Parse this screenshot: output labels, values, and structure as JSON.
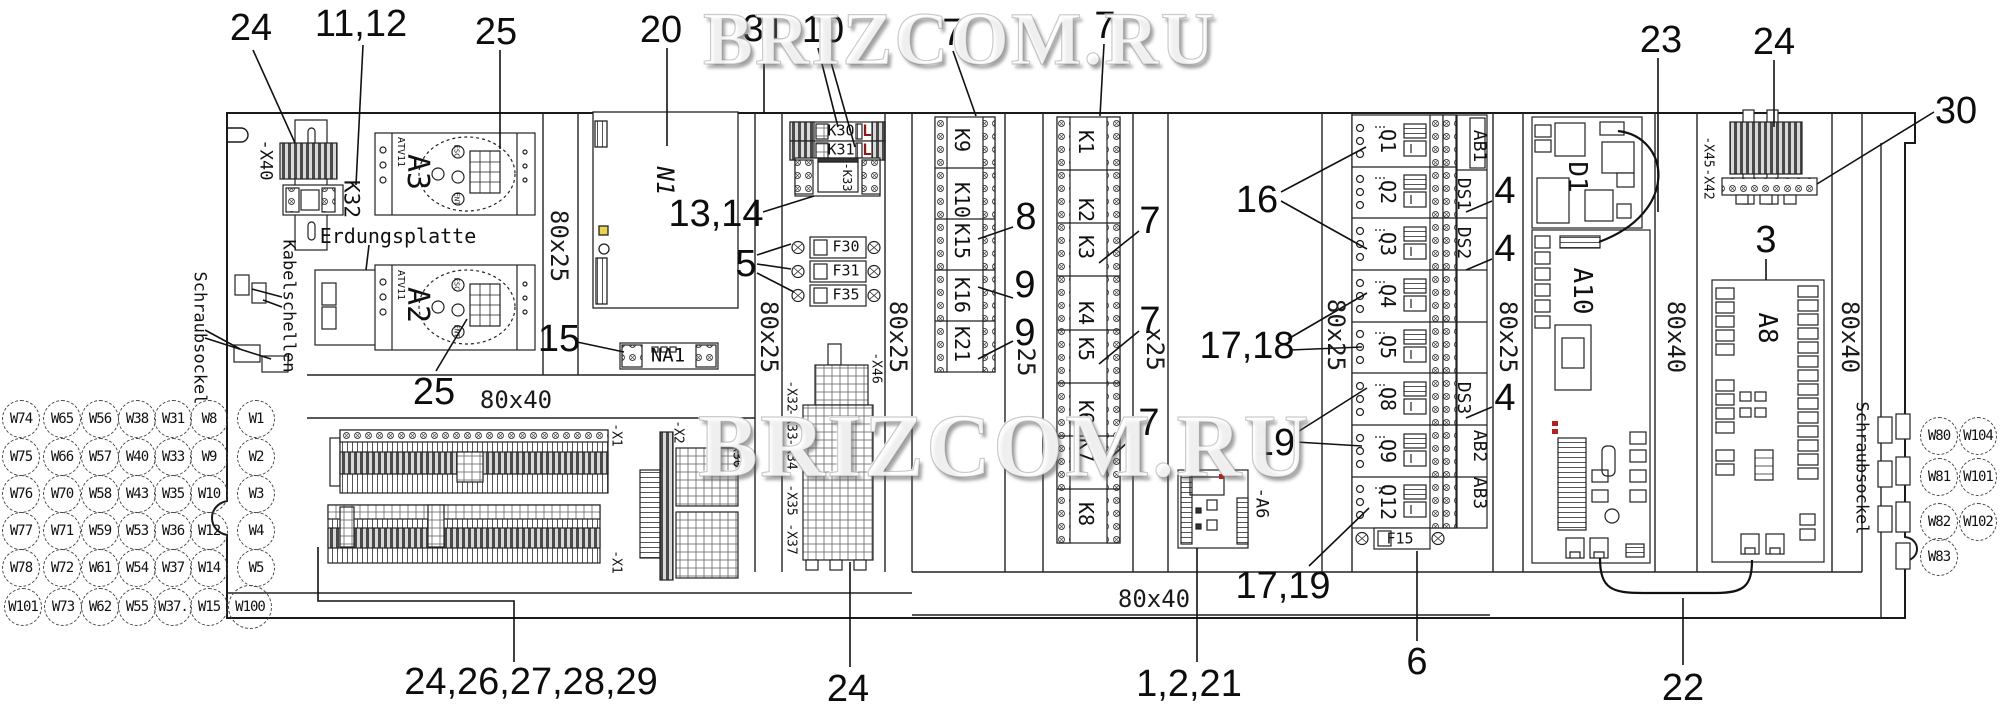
{
  "watermark": {
    "text": "BRIZCOM.RU"
  },
  "colors": {
    "line": "#1a1a1a",
    "background": "#ffffff",
    "led_red": "#b22222",
    "marker_yellow": "#e8d44d",
    "relay_l_red": "#8b1a1a"
  },
  "callouts": [
    {
      "t": "24",
      "x": 251,
      "y": 28
    },
    {
      "t": "11,12",
      "x": 361,
      "y": 24
    },
    {
      "t": "25",
      "x": 496,
      "y": 32
    },
    {
      "t": "20",
      "x": 661,
      "y": 30
    },
    {
      "t": "31",
      "x": 764,
      "y": 29
    },
    {
      "t": "10",
      "x": 823,
      "y": 30
    },
    {
      "t": "7",
      "x": 953,
      "y": 33
    },
    {
      "t": "7",
      "x": 1105,
      "y": 26
    },
    {
      "t": "23",
      "x": 1661,
      "y": 40
    },
    {
      "t": "24",
      "x": 1774,
      "y": 42
    },
    {
      "t": "30",
      "x": 1956,
      "y": 111
    },
    {
      "t": "13,14",
      "x": 716,
      "y": 214
    },
    {
      "t": "5",
      "x": 746,
      "y": 264
    },
    {
      "t": "15",
      "x": 559,
      "y": 339
    },
    {
      "t": "8",
      "x": 1026,
      "y": 217
    },
    {
      "t": "9",
      "x": 1025,
      "y": 285
    },
    {
      "t": "9",
      "x": 1025,
      "y": 333
    },
    {
      "t": "7",
      "x": 1150,
      "y": 221
    },
    {
      "t": "7",
      "x": 1150,
      "y": 321
    },
    {
      "t": "7",
      "x": 1149,
      "y": 423
    },
    {
      "t": "16",
      "x": 1257,
      "y": 200
    },
    {
      "t": "17,18",
      "x": 1247,
      "y": 346
    },
    {
      "t": "19",
      "x": 1274,
      "y": 443
    },
    {
      "t": "4",
      "x": 1505,
      "y": 191
    },
    {
      "t": "4",
      "x": 1505,
      "y": 249
    },
    {
      "t": "4",
      "x": 1505,
      "y": 398
    },
    {
      "t": "3",
      "x": 1766,
      "y": 240
    },
    {
      "t": "17,19",
      "x": 1283,
      "y": 586
    },
    {
      "t": "6",
      "x": 1417,
      "y": 662
    },
    {
      "t": "1,2,21",
      "x": 1189,
      "y": 684
    },
    {
      "t": "24",
      "x": 848,
      "y": 689
    },
    {
      "t": "24,26,27,28,29",
      "x": 531,
      "y": 682
    },
    {
      "t": "22",
      "x": 1683,
      "y": 688
    },
    {
      "t": "25",
      "x": 434,
      "y": 392
    }
  ],
  "duct_labels": [
    {
      "t": "80x25",
      "x": 559,
      "y": 246,
      "rot": 90
    },
    {
      "t": "80x25",
      "x": 769,
      "y": 337,
      "rot": 90
    },
    {
      "t": "80x25",
      "x": 898,
      "y": 337,
      "rot": 90
    },
    {
      "t": "80x25",
      "x": 1336,
      "y": 335,
      "rot": 90
    },
    {
      "t": "80x25",
      "x": 1508,
      "y": 337,
      "rot": 90
    },
    {
      "t": "x25",
      "x": 1155,
      "y": 349,
      "rot": 90
    },
    {
      "t": "25",
      "x": 1026,
      "y": 362,
      "rot": 90
    },
    {
      "t": "80x40",
      "x": 1676,
      "y": 337,
      "rot": 90
    },
    {
      "t": "80x40",
      "x": 1850,
      "y": 337,
      "rot": 90
    },
    {
      "t": "80x40",
      "x": 516,
      "y": 400
    },
    {
      "t": "80x40",
      "x": 1154,
      "y": 599
    }
  ],
  "component_labels": [
    {
      "t": "-X40",
      "x": 265,
      "y": 160,
      "rot": 90,
      "fs": 17
    },
    {
      "t": "K32",
      "x": 351,
      "y": 199,
      "rot": 90,
      "fs": 21
    },
    {
      "t": "Erdungsplatte",
      "x": 398,
      "y": 236,
      "fs": 20
    },
    {
      "t": "Kabelschellen",
      "x": 288,
      "y": 306,
      "rot": 90,
      "fs": 17
    },
    {
      "t": "Schraubsockel",
      "x": 199,
      "y": 338,
      "rot": 90,
      "fs": 17
    },
    {
      "t": "Schraubsockel",
      "x": 1861,
      "y": 468,
      "rot": 90,
      "fs": 17
    },
    {
      "t": "ATV11",
      "x": 400,
      "y": 152,
      "rot": 90,
      "fs": 10
    },
    {
      "t": "ATV11",
      "x": 400,
      "y": 285,
      "rot": 90,
      "fs": 10
    },
    {
      "t": "A3",
      "x": 417,
      "y": 172,
      "rot": 90,
      "fs": 30
    },
    {
      "t": "A2",
      "x": 417,
      "y": 305,
      "rot": 90,
      "fs": 30
    },
    {
      "t": "ESC",
      "x": 456,
      "y": 151,
      "rot": 90,
      "fs": 7
    },
    {
      "t": "ENT",
      "x": 456,
      "y": 199,
      "rot": 90,
      "fs": 7
    },
    {
      "t": "ESC",
      "x": 456,
      "y": 284,
      "rot": 90,
      "fs": 7
    },
    {
      "t": "ENT",
      "x": 456,
      "y": 331,
      "rot": 90,
      "fs": 7
    },
    {
      "t": "N1",
      "x": 665,
      "y": 181,
      "rot": 90,
      "fs": 24,
      "italic": true
    },
    {
      "t": "NA1",
      "x": 668,
      "y": 356,
      "fs": 19
    },
    {
      "t": "K30",
      "x": 841,
      "y": 131,
      "fs": 15
    },
    {
      "t": "K31",
      "x": 841,
      "y": 150,
      "fs": 15
    },
    {
      "t": "L",
      "x": 867,
      "y": 131,
      "fs": 16,
      "bold": true,
      "red": true
    },
    {
      "t": "L",
      "x": 867,
      "y": 150,
      "fs": 16,
      "bold": true,
      "red": true
    },
    {
      "t": "-K33",
      "x": 847,
      "y": 177,
      "rot": 90,
      "fs": 12
    },
    {
      "t": "F30",
      "x": 846,
      "y": 247,
      "fs": 15
    },
    {
      "t": "F31",
      "x": 846,
      "y": 271,
      "fs": 15
    },
    {
      "t": "F35",
      "x": 846,
      "y": 295,
      "fs": 15
    },
    {
      "t": "F15",
      "x": 1400,
      "y": 539,
      "fs": 15
    },
    {
      "t": "K9",
      "x": 962,
      "y": 140,
      "rot": 90,
      "fs": 20
    },
    {
      "t": "K10",
      "x": 962,
      "y": 200,
      "rot": 90,
      "fs": 20
    },
    {
      "t": "K15",
      "x": 962,
      "y": 241,
      "rot": 90,
      "fs": 20
    },
    {
      "t": "K16",
      "x": 962,
      "y": 295,
      "rot": 90,
      "fs": 20
    },
    {
      "t": "K21",
      "x": 962,
      "y": 344,
      "rot": 90,
      "fs": 20
    },
    {
      "t": "K1",
      "x": 1086,
      "y": 142,
      "rot": 90,
      "fs": 20
    },
    {
      "t": "K2",
      "x": 1086,
      "y": 210,
      "rot": 90,
      "fs": 20
    },
    {
      "t": "K3",
      "x": 1086,
      "y": 247,
      "rot": 90,
      "fs": 20
    },
    {
      "t": "K4",
      "x": 1086,
      "y": 313,
      "rot": 90,
      "fs": 20
    },
    {
      "t": "K5",
      "x": 1086,
      "y": 349,
      "rot": 90,
      "fs": 20
    },
    {
      "t": "K6",
      "x": 1086,
      "y": 412,
      "rot": 90,
      "fs": 20
    },
    {
      "t": "K7",
      "x": 1086,
      "y": 450,
      "rot": 90,
      "fs": 20
    },
    {
      "t": "K8",
      "x": 1086,
      "y": 514,
      "rot": 90,
      "fs": 20
    },
    {
      "t": "Q1",
      "x": 1388,
      "y": 141,
      "rot": 90,
      "fs": 20
    },
    {
      "t": "Q2",
      "x": 1388,
      "y": 192,
      "rot": 90,
      "fs": 20
    },
    {
      "t": "Q3",
      "x": 1388,
      "y": 244,
      "rot": 90,
      "fs": 20
    },
    {
      "t": "Q4",
      "x": 1388,
      "y": 296,
      "rot": 90,
      "fs": 20
    },
    {
      "t": "Q5",
      "x": 1388,
      "y": 347,
      "rot": 90,
      "fs": 20
    },
    {
      "t": "Q8",
      "x": 1388,
      "y": 399,
      "rot": 90,
      "fs": 20
    },
    {
      "t": "Q9",
      "x": 1388,
      "y": 451,
      "rot": 90,
      "fs": 20
    },
    {
      "t": "Q12",
      "x": 1388,
      "y": 502,
      "rot": 90,
      "fs": 20
    },
    {
      "t": "AB1",
      "x": 1479,
      "y": 146,
      "rot": 90,
      "fs": 18
    },
    {
      "t": "DS1",
      "x": 1463,
      "y": 194,
      "rot": 90,
      "fs": 18
    },
    {
      "t": "DS2",
      "x": 1463,
      "y": 243,
      "rot": 90,
      "fs": 18
    },
    {
      "t": "DS3",
      "x": 1463,
      "y": 398,
      "rot": 90,
      "fs": 18
    },
    {
      "t": "AB2",
      "x": 1479,
      "y": 446,
      "rot": 90,
      "fs": 18
    },
    {
      "t": "AB3",
      "x": 1479,
      "y": 493,
      "rot": 90,
      "fs": 18
    },
    {
      "t": "-A6",
      "x": 1261,
      "y": 503,
      "rot": 90,
      "fs": 17
    },
    {
      "t": "D1",
      "x": 1577,
      "y": 177,
      "rot": 90,
      "fs": 26
    },
    {
      "t": "A10",
      "x": 1582,
      "y": 291,
      "rot": 90,
      "fs": 26
    },
    {
      "t": "A8",
      "x": 1767,
      "y": 328,
      "rot": 90,
      "fs": 26
    },
    {
      "t": "-X45",
      "x": 1708,
      "y": 152,
      "rot": 90,
      "fs": 13
    },
    {
      "t": "-X42",
      "x": 1708,
      "y": 184,
      "rot": 90,
      "fs": 13
    },
    {
      "t": "-X1",
      "x": 616,
      "y": 435,
      "rot": 90,
      "fs": 13
    },
    {
      "t": "-X1",
      "x": 616,
      "y": 562,
      "rot": 90,
      "fs": 13
    },
    {
      "t": "-X2",
      "x": 678,
      "y": 432,
      "rot": 90,
      "fs": 13
    },
    {
      "t": "-X30",
      "x": 737,
      "y": 452,
      "rot": 90,
      "fs": 13
    },
    {
      "t": "-X46",
      "x": 876,
      "y": 368,
      "rot": 90,
      "fs": 13
    },
    {
      "t": "-X32",
      "x": 791,
      "y": 396,
      "rot": 90,
      "fs": 13
    },
    {
      "t": "-X33",
      "x": 791,
      "y": 424,
      "rot": 90,
      "fs": 13
    },
    {
      "t": "-X34",
      "x": 791,
      "y": 454,
      "rot": 90,
      "fs": 13
    },
    {
      "t": "-X35",
      "x": 791,
      "y": 500,
      "rot": 90,
      "fs": 13
    },
    {
      "t": "-X37",
      "x": 791,
      "y": 539,
      "rot": 90,
      "fs": 13
    }
  ],
  "wires": {
    "left": [
      {
        "t": "W74",
        "x": 21,
        "y": 419
      },
      {
        "t": "W65",
        "x": 62,
        "y": 419
      },
      {
        "t": "W56",
        "x": 100,
        "y": 419
      },
      {
        "t": "W38",
        "x": 137,
        "y": 419
      },
      {
        "t": "W31",
        "x": 173,
        "y": 419
      },
      {
        "t": "W8",
        "x": 209,
        "y": 419
      },
      {
        "t": "W1",
        "x": 256,
        "y": 419
      },
      {
        "t": "W75",
        "x": 21,
        "y": 457
      },
      {
        "t": "W66",
        "x": 62,
        "y": 457
      },
      {
        "t": "W57",
        "x": 100,
        "y": 457
      },
      {
        "t": "W40",
        "x": 137,
        "y": 457
      },
      {
        "t": "W33",
        "x": 173,
        "y": 457
      },
      {
        "t": "W9",
        "x": 209,
        "y": 457
      },
      {
        "t": "W2",
        "x": 256,
        "y": 457
      },
      {
        "t": "W76",
        "x": 21,
        "y": 494
      },
      {
        "t": "W70",
        "x": 62,
        "y": 494
      },
      {
        "t": "W58",
        "x": 100,
        "y": 494
      },
      {
        "t": "W43",
        "x": 137,
        "y": 494
      },
      {
        "t": "W35",
        "x": 173,
        "y": 494
      },
      {
        "t": "W10",
        "x": 209,
        "y": 494
      },
      {
        "t": "W3",
        "x": 256,
        "y": 494
      },
      {
        "t": "W77",
        "x": 21,
        "y": 531
      },
      {
        "t": "W71",
        "x": 62,
        "y": 531
      },
      {
        "t": "W59",
        "x": 100,
        "y": 531
      },
      {
        "t": "W53",
        "x": 137,
        "y": 531
      },
      {
        "t": "W36",
        "x": 173,
        "y": 531
      },
      {
        "t": "W12",
        "x": 209,
        "y": 531
      },
      {
        "t": "W4",
        "x": 256,
        "y": 531
      },
      {
        "t": "W78",
        "x": 21,
        "y": 568
      },
      {
        "t": "W72",
        "x": 62,
        "y": 568
      },
      {
        "t": "W61",
        "x": 100,
        "y": 568
      },
      {
        "t": "W54",
        "x": 137,
        "y": 568
      },
      {
        "t": "W37",
        "x": 173,
        "y": 568
      },
      {
        "t": "W14",
        "x": 209,
        "y": 568
      },
      {
        "t": "W5",
        "x": 256,
        "y": 568
      },
      {
        "t": "W101",
        "x": 23,
        "y": 607
      },
      {
        "t": "W73",
        "x": 63,
        "y": 607
      },
      {
        "t": "W62",
        "x": 100,
        "y": 607
      },
      {
        "t": "W55",
        "x": 137,
        "y": 607
      },
      {
        "t": "W37.",
        "x": 173,
        "y": 607
      },
      {
        "t": "W15",
        "x": 209,
        "y": 607
      },
      {
        "t": "W100",
        "x": 250,
        "y": 607,
        "d": 44
      }
    ],
    "right": [
      {
        "t": "W80",
        "x": 1939,
        "y": 436
      },
      {
        "t": "W104",
        "x": 1978,
        "y": 436
      },
      {
        "t": "W81",
        "x": 1939,
        "y": 477
      },
      {
        "t": "W101",
        "x": 1978,
        "y": 477
      },
      {
        "t": "W82",
        "x": 1939,
        "y": 522
      },
      {
        "t": "W102",
        "x": 1978,
        "y": 522
      },
      {
        "t": "W83",
        "x": 1939,
        "y": 557
      }
    ]
  }
}
